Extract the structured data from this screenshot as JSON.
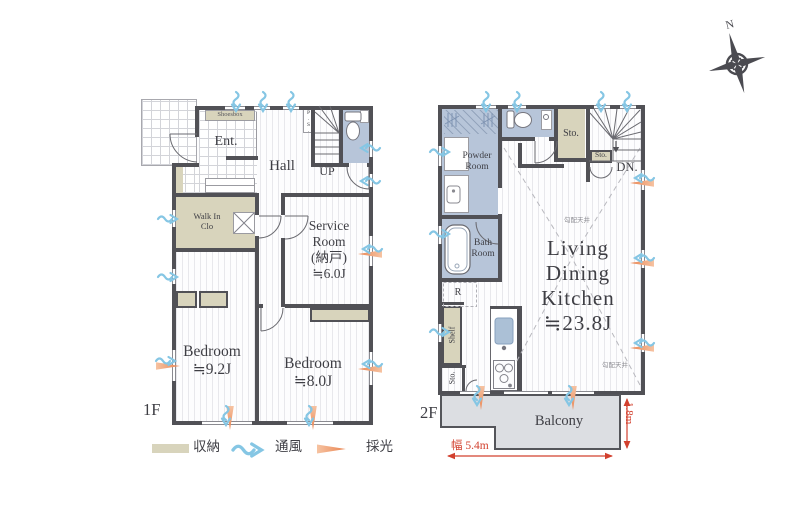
{
  "compass": {
    "north": "N"
  },
  "floor1": {
    "floor_label": "1F",
    "entrance": "Ent.",
    "shoesbox": "Shoesbox",
    "hall": "Hall",
    "stairs": "UP",
    "pipe_space": "P.S.",
    "walk_in_closet": [
      "Walk In",
      "Clo"
    ],
    "service_room": [
      "Service",
      "Room",
      "(納戸)",
      "≒6.0J"
    ],
    "bedroom_1": [
      "Bedroom",
      "≒9.2J"
    ],
    "bedroom_2": [
      "Bedroom",
      "≒8.0J"
    ]
  },
  "floor2": {
    "floor_label": "2F",
    "powder_room": [
      "Powder",
      "Room"
    ],
    "bath_room": [
      "Bath",
      "Room"
    ],
    "storage_top": "Sto.",
    "storage_mid": "Sto.",
    "storage_bottom": "Sto.",
    "stairs": "DN.",
    "refrigerator": "R",
    "shelf": "Shelf",
    "ldk": [
      "Living",
      "Dining",
      "Kitchen",
      "≒23.8J"
    ],
    "sloped_ceiling_note_1": "勾配天井",
    "sloped_ceiling_note_2": "勾配天井",
    "balcony": "Balcony",
    "dim_width": "幅 5.4m",
    "dim_depth": "1.8m"
  },
  "legend": {
    "storage": "収納",
    "ventilation": "通風",
    "daylight": "採光"
  },
  "colors": {
    "wall": "#515156",
    "storage_fill": "#d8d4bc",
    "wet_area_fill": "#b7c5d9",
    "balcony_fill": "#dcdee2",
    "dimension_red": "#d2402e",
    "ventilation_blue": "#85c6e4",
    "daylight_orange": "#ee9463"
  }
}
